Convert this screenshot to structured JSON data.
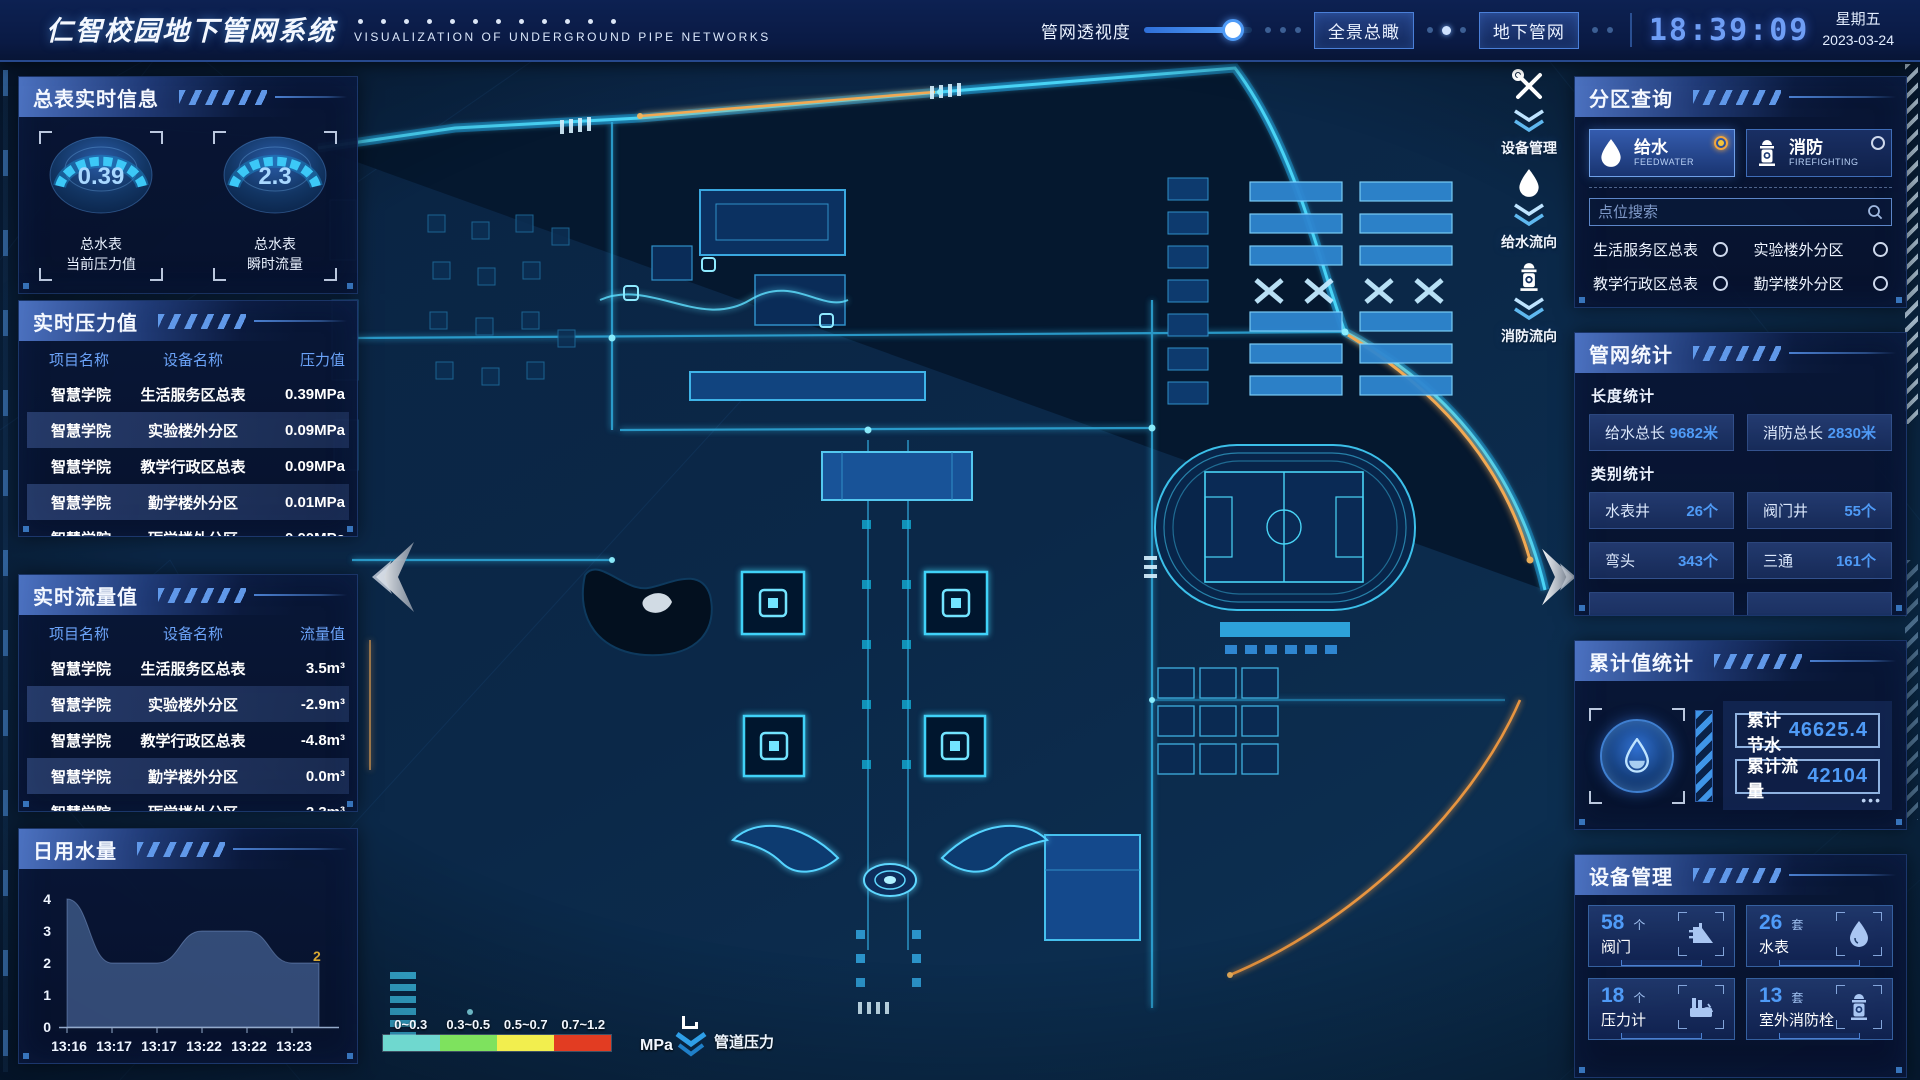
{
  "header": {
    "title": "仁智校园地下管网系统",
    "subtitle": "VISUALIZATION OF UNDERGROUND PIPE NETWORKS",
    "transparency_label": "管网透视度",
    "btn_overview": "全景总瞰",
    "btn_underground": "地下管网",
    "clock": "18:39:09",
    "weekday": "星期五",
    "date": "2023-03-24"
  },
  "left": {
    "master_panel": {
      "title": "总表实时信息",
      "gauges": [
        {
          "value": "0.39",
          "label1": "总水表",
          "label2": "当前压力值"
        },
        {
          "value": "2.3",
          "label1": "总水表",
          "label2": "瞬时流量"
        }
      ]
    },
    "pressure_panel": {
      "title": "实时压力值",
      "headers": [
        "项目名称",
        "设备名称",
        "压力值"
      ],
      "rows": [
        [
          "智慧学院",
          "生活服务区总表",
          "0.39MPa"
        ],
        [
          "智慧学院",
          "实验楼外分区",
          "0.09MPa"
        ],
        [
          "智慧学院",
          "教学行政区总表",
          "0.09MPa"
        ],
        [
          "智慧学院",
          "勤学楼外分区",
          "0.01MPa"
        ],
        [
          "智慧学院",
          "砺学楼外分区",
          "0.00MPa"
        ]
      ]
    },
    "flow_panel": {
      "title": "实时流量值",
      "headers": [
        "项目名称",
        "设备名称",
        "流量值"
      ],
      "rows": [
        [
          "智慧学院",
          "生活服务区总表",
          "3.5m³"
        ],
        [
          "智慧学院",
          "实验楼外分区",
          "-2.9m³"
        ],
        [
          "智慧学院",
          "教学行政区总表",
          "-4.8m³"
        ],
        [
          "智慧学院",
          "勤学楼外分区",
          "0.0m³"
        ],
        [
          "智慧学院",
          "砺学楼外分区",
          "2.3m³"
        ]
      ]
    },
    "daily_panel": {
      "title": "日用水量"
    }
  },
  "chart_data": {
    "type": "area",
    "title": "日用水量",
    "x": [
      "13:16",
      "13:17",
      "13:17",
      "13:22",
      "13:22",
      "13:23"
    ],
    "values": [
      4,
      2,
      2,
      3,
      3,
      2
    ],
    "yticks": [
      0,
      1,
      2,
      3,
      4
    ],
    "ylim": [
      0,
      4
    ],
    "end_label": "2",
    "grid": false,
    "legend_position": "none"
  },
  "right": {
    "zone_panel": {
      "title": "分区查询",
      "feedwater": {
        "cn": "给水",
        "en": "FEEDWATER",
        "selected": true
      },
      "fire": {
        "cn": "消防",
        "en": "FIREFIGHTING",
        "selected": false
      },
      "search_placeholder": "点位搜索",
      "items": [
        "生活服务区总表",
        "实验楼外分区",
        "教学行政区总表",
        "勤学楼外分区",
        "砺学楼外分区",
        "宿舍区泵房"
      ]
    },
    "stats_panel": {
      "title": "管网统计",
      "length_title": "长度统计",
      "length_stats": [
        {
          "label": "给水总长",
          "value": "9682米"
        },
        {
          "label": "消防总长",
          "value": "2830米"
        }
      ],
      "category_title": "类别统计",
      "category_stats": [
        {
          "label": "水表井",
          "value": "26个"
        },
        {
          "label": "阀门井",
          "value": "55个"
        },
        {
          "label": "弯头",
          "value": "343个"
        },
        {
          "label": "三通",
          "value": "161个"
        }
      ]
    },
    "cumulative_panel": {
      "title": "累计值统计",
      "items": [
        {
          "label": "累计节水",
          "value": "46625.4"
        },
        {
          "label": "累计流量",
          "value": "42104"
        }
      ]
    },
    "device_panel": {
      "title": "设备管理",
      "devices": [
        {
          "count": "58",
          "unit": "个",
          "label": "阀门"
        },
        {
          "count": "26",
          "unit": "套",
          "label": "水表"
        },
        {
          "count": "18",
          "unit": "个",
          "label": "压力计"
        },
        {
          "count": "13",
          "unit": "套",
          "label": "室外消防栓"
        }
      ]
    }
  },
  "map": {
    "float_buttons": [
      {
        "label": "设备管理"
      },
      {
        "label": "给水流向"
      },
      {
        "label": "消防流向"
      }
    ],
    "legend": {
      "ranges": [
        {
          "label": "0~0.3",
          "color": "#6fd8cf"
        },
        {
          "label": "0.3~0.5",
          "color": "#7ee25e"
        },
        {
          "label": "0.5~0.7",
          "color": "#f2ee4e"
        },
        {
          "label": "0.7~1.2",
          "color": "#e23c22"
        }
      ],
      "unit": "MPa",
      "pressure_label": "管道压力"
    }
  },
  "colors": {
    "accent_cyan": "#49d4f6",
    "accent_blue": "#4f9bf7",
    "accent_orange": "#f2a952",
    "clock_blue": "#6f9ef5",
    "panel_border": "#3a6abe"
  }
}
